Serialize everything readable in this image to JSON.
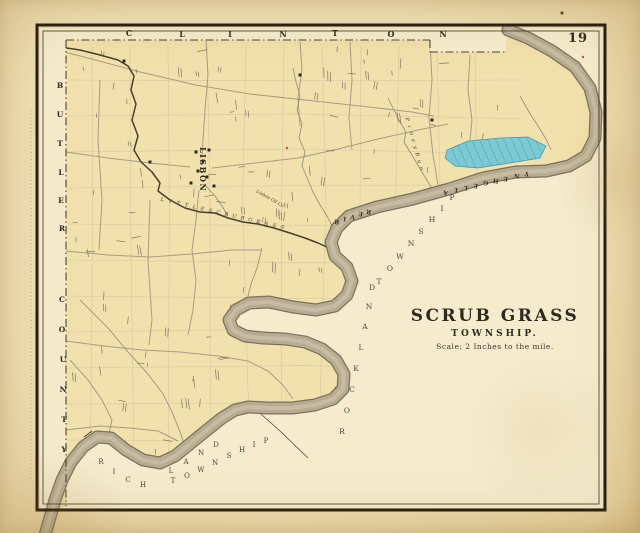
{
  "page_number": "19",
  "title_block": {
    "title": "SCRUB GRASS",
    "subtitle": "TOWNSHIP.",
    "scale_note": "Scale: 2 Inches to the mile."
  },
  "border_labels": {
    "top": "CLINTON",
    "left_upper": "BUTLER",
    "left_lower": "COUNTY"
  },
  "adjacent_townships": {
    "east_name": "ROCKLAND",
    "east_word2": "TOWNSHIP",
    "south_name": "RICHLAND",
    "south_word2": "TOWNSHIP"
  },
  "river_labels": {
    "allegheny": "ALLEGHENY",
    "river": "RIVER"
  },
  "water_features": {
    "creek_label": "LITTLE SCRUB GRASS",
    "run_label": "Piney Run"
  },
  "settlements": {
    "village": "LISBON",
    "company": "Lisbon Oil Co"
  },
  "colors": {
    "paper": "#f0e0b6",
    "map_interior": "#f6eccd",
    "township_fill": "#f1e1ac",
    "river_fill": "#b7ac92",
    "river_edge": "#6e6553",
    "river_highlight": "#d5cbaf",
    "water_parcel": "#7cc8d3",
    "water_parcel_hatch": "#3f98a8",
    "frame": "#231d12",
    "ink": "#2e2a20",
    "faded_ink": "#4a453a",
    "road": "#a89d83",
    "creek": "#8b8e79",
    "dark_stream": "#46412f",
    "parcel_line": "#cfc2a2"
  }
}
